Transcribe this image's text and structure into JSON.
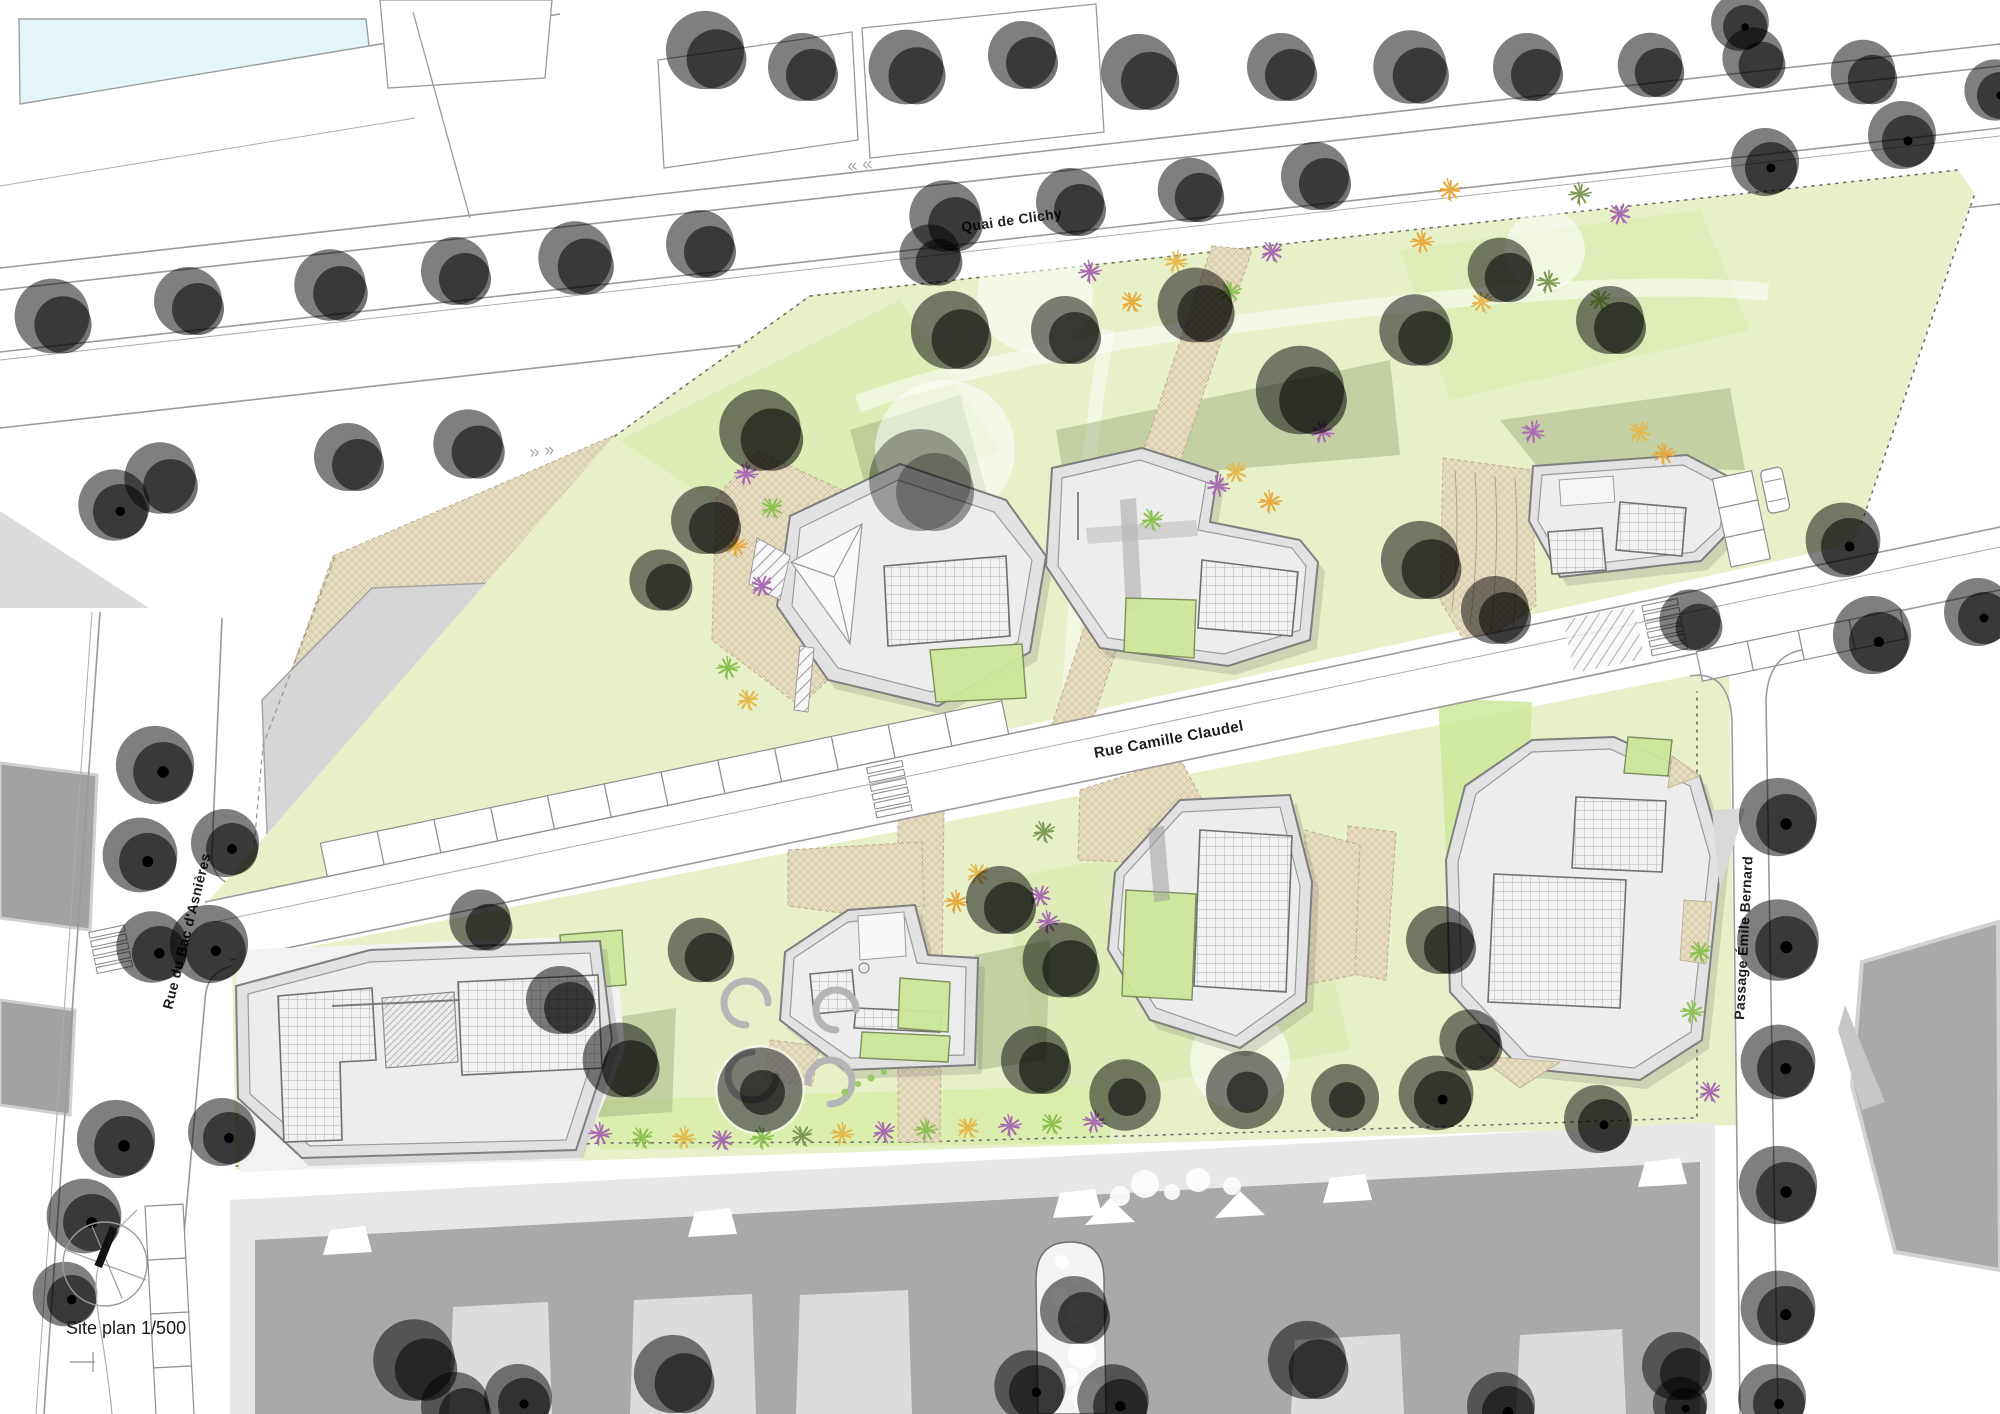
{
  "labels": {
    "quai_de_clichy": "Quai de Clichy",
    "rue_camille_claudel": "Rue Camille Claudel",
    "rue_du_bac": "Rue du Bac d'Asnières",
    "passage_emile_bernard": "Passage Émile Bernard",
    "scale_label": "Site plan 1/500"
  },
  "icons": {
    "north_arrow": "north-arrow-compass"
  },
  "colors": {
    "park": "#e7f0c8",
    "park2": "#dcebb2",
    "lawn": "#cde79a",
    "tan": "#e6ddc3",
    "road_line": "#9a9a9a",
    "water": "#e2f6f9",
    "ctx_dark": "#a9a9a9",
    "ctx_light": "#e7e7e7",
    "tree_green": "#bce180",
    "tree_green2": "#a6d662",
    "tree_bright": "#9ed455",
    "tree_purple": "#9e87ae",
    "tree_purple2": "#84709a",
    "tree_salmon": "#f2c9b1",
    "tree_salmon2": "#e9b093",
    "shrub_purple": "#a86bb2",
    "shrub_orange": "#e8a93e",
    "shrub_green": "#8cc152",
    "olive": "#94a573"
  }
}
